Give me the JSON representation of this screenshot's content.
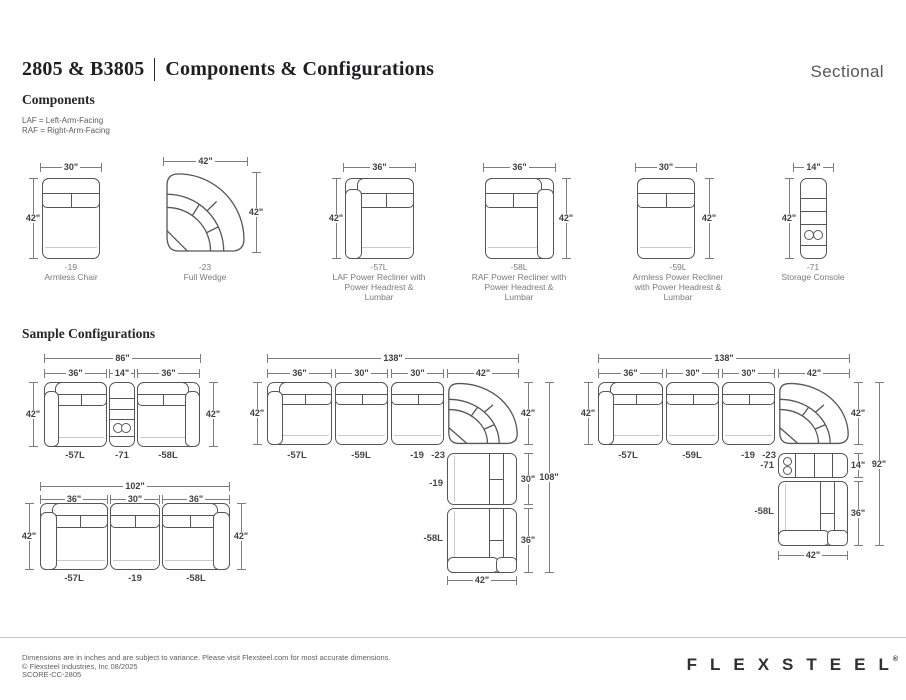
{
  "header": {
    "model": "2805 & B3805",
    "title": "Components & Configurations",
    "category": "Sectional",
    "components_heading": "Components",
    "legend": [
      "LAF = Left-Arm-Facing",
      "RAF = Right-Arm-Facing"
    ],
    "configs_heading": "Sample Configurations"
  },
  "components": [
    {
      "code": "-19",
      "name": "Armless Chair",
      "width": "30\"",
      "height": "42\""
    },
    {
      "code": "-23",
      "name": "Full Wedge",
      "width": "42\"",
      "height": "42\""
    },
    {
      "code": "-57L",
      "name": "LAF Power Recliner with Power Headrest & Lumbar",
      "width": "36\"",
      "height": "42\""
    },
    {
      "code": "-58L",
      "name": "RAF Power Recliner with Power Headrest & Lumbar",
      "width": "36\"",
      "height": "42\""
    },
    {
      "code": "-59L",
      "name": "Armless Power Recliner with Power Headrest & Lumbar",
      "width": "30\"",
      "height": "42\""
    },
    {
      "code": "-71",
      "name": "Storage Console",
      "width": "14\"",
      "height": "42\""
    }
  ],
  "config1": {
    "total_width": "86\"",
    "widths": [
      "36\"",
      "14\"",
      "36\""
    ],
    "height_left": "42\"",
    "height_right": "42\"",
    "labels": [
      "-57L",
      "-71",
      "-58L"
    ]
  },
  "config2": {
    "total_width": "138\"",
    "widths": [
      "36\"",
      "30\"",
      "30\"",
      "42\""
    ],
    "height_left": "42\"",
    "side_heights": [
      "42\"",
      "30\"",
      "36\""
    ],
    "total_height": "108\"",
    "bottom_width": "42\"",
    "row_labels": [
      "-57L",
      "-59L",
      "-19",
      "-23"
    ],
    "column_labels": [
      "-19",
      "-58L"
    ]
  },
  "config3": {
    "total_width": "138\"",
    "widths": [
      "36\"",
      "30\"",
      "30\"",
      "42\""
    ],
    "height_left": "42\"",
    "side_heights": [
      "42\"",
      "14\"",
      "36\""
    ],
    "total_height": "92\"",
    "bottom_width": "42\"",
    "row_labels": [
      "-57L",
      "-59L",
      "-19",
      "-23"
    ],
    "column_labels": [
      "-71",
      "-58L"
    ]
  },
  "config4": {
    "total_width": "102\"",
    "widths": [
      "36\"",
      "30\"",
      "36\""
    ],
    "height_left": "42\"",
    "height_right": "42\"",
    "labels": [
      "-57L",
      "-19",
      "-58L"
    ]
  },
  "footer": {
    "disclaimer": "Dimensions are in inches and are subject to variance. Please visit Flexsteel.com for most accurate dimensions.",
    "copyright": "© Flexsteel Industries, Inc 08/2025",
    "sku": "SCORE-CC-2805",
    "brand": "FLEXSTEEL",
    "trademark": "®"
  }
}
